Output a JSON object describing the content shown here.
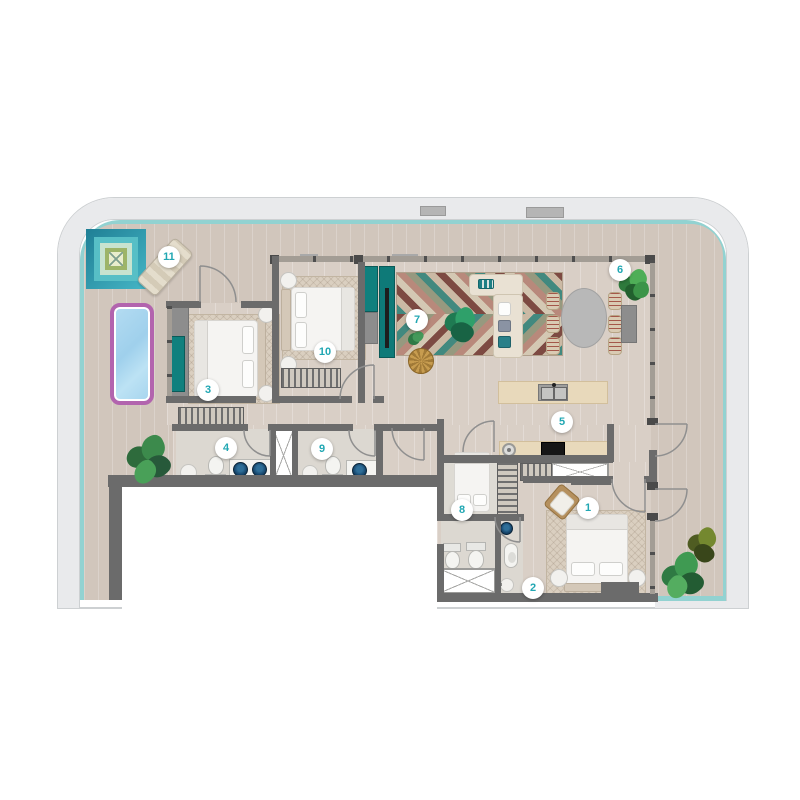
{
  "floorplan": {
    "badges": [
      {
        "label": "1"
      },
      {
        "label": "2"
      },
      {
        "label": "3"
      },
      {
        "label": "4"
      },
      {
        "label": "5"
      },
      {
        "label": "6"
      },
      {
        "label": "7"
      },
      {
        "label": "8"
      },
      {
        "label": "9"
      },
      {
        "label": "10"
      },
      {
        "label": "11"
      }
    ],
    "colors": {
      "badge_number": "#21a7b3",
      "glass_facade": "#92d2d1",
      "outer_band": "#e9eaec",
      "wall": "#6b6b6b",
      "terrace_floor": "#d1c6bc",
      "interior_floor": "#d9cfc6",
      "pool_water": "#a5d4ee",
      "pool_border": "#b264ae",
      "media_unit_teal": "#0e7a78",
      "vessel_sink_navy": "#16456b",
      "kitchen_wood": "#e8d9bb",
      "rug_chevron_teal": "#41897f",
      "rug_chevron_maroon": "#7d4a42"
    }
  }
}
